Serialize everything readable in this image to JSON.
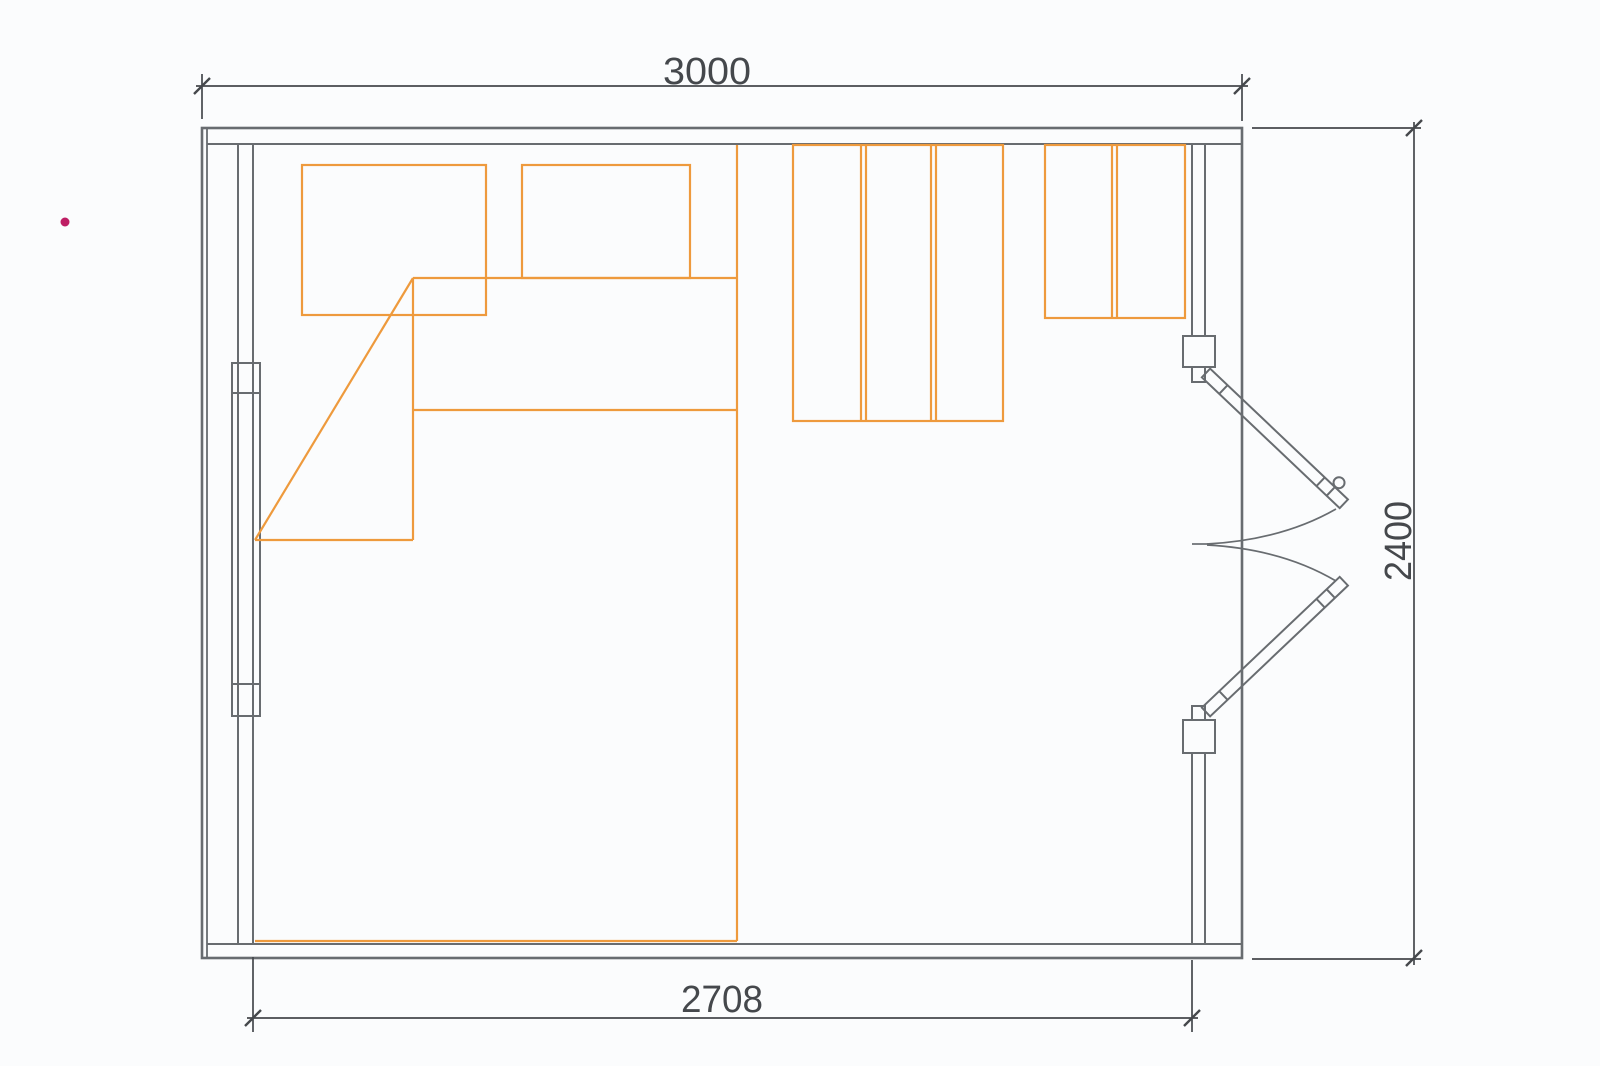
{
  "drawing": {
    "type": "floor-plan",
    "dimension_labels": {
      "top_width": "3000",
      "bottom_interior_width": "2708",
      "right_height": "2400"
    },
    "colors": {
      "background": "#FBFCFD",
      "structure": "#686C70",
      "dimension": "#45484C",
      "furniture": "#EE9A3D",
      "marker": "#BE1E64"
    },
    "elements": {
      "openings": [
        "left-window",
        "right-double-door"
      ],
      "furniture": [
        "bed",
        "pillow-left",
        "pillow-right",
        "blanket-fold",
        "wardrobe-left",
        "wardrobe-right"
      ]
    }
  }
}
